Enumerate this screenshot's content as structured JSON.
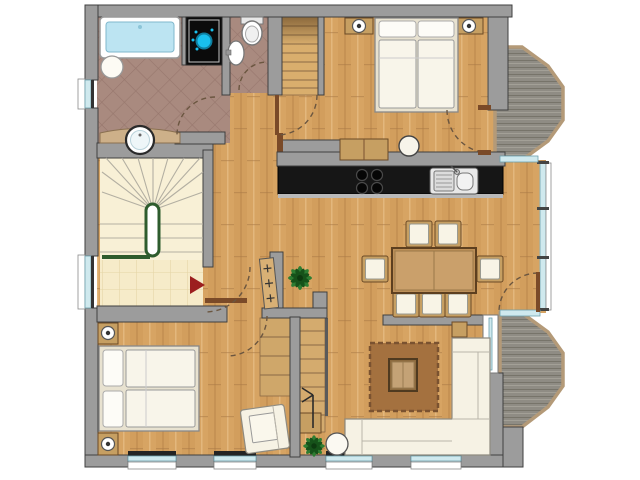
{
  "title": "apartment-floor-plan",
  "colors": {
    "background": "#ffffff",
    "wall": "#9c9c9c",
    "wallStroke": "#3f3f3f",
    "wood": "#d7a463",
    "woodStripe": "#c9934f",
    "bathTile": "#a98a7f",
    "bathTileLine": "#97776d",
    "creamTile": "#f6ebc9",
    "creamTileLine": "#e4d5a5",
    "stairTread": "#f8f0d6",
    "deck": "#8f8c84",
    "deckBorder": "#b49a78",
    "counter": "#161616",
    "counterEdge": "#b9b9b9",
    "fabric": "#f6f2e4",
    "furnitureWood": "#c69f62",
    "rug": "#a4713f",
    "glass": "#cfe9ee",
    "plantGreen": "#2e7d32",
    "plantGreenDark": "#16521a",
    "stairRail": "#2e5c2e",
    "entryArrow": "#9c1f1f",
    "showerBlue": "#19c0ee",
    "tubBlue": "#bce4f2",
    "doorArc": "#6b5640",
    "jamb": "#7a4a28"
  },
  "rooms": [
    {
      "id": "bathroom"
    },
    {
      "id": "wc"
    },
    {
      "id": "bedroom-top"
    },
    {
      "id": "kitchen"
    },
    {
      "id": "dining-area"
    },
    {
      "id": "living-area"
    },
    {
      "id": "bedroom-bottom"
    },
    {
      "id": "entry-hall"
    },
    {
      "id": "staircase-main"
    },
    {
      "id": "staircase-secondary"
    },
    {
      "id": "balcony-top"
    },
    {
      "id": "balcony-bottom"
    }
  ],
  "fixtures": {
    "bathroom": [
      "bathtub",
      "shower",
      "round-basin",
      "vanity-counter",
      "vanity-sink"
    ],
    "wc": [
      "toilet",
      "hand-basin"
    ],
    "bedroom-top": [
      "double-bed",
      "nightstand-left",
      "nightstand-right",
      "table-lamp-left",
      "table-lamp-right",
      "dresser",
      "stool"
    ],
    "bedroom-bottom": [
      "double-bed",
      "nightstand-top",
      "nightstand-bottom",
      "table-lamp-top",
      "table-lamp-bottom",
      "armchair"
    ],
    "kitchen": [
      "counter",
      "cooktop",
      "double-sink",
      "tall-cabinet"
    ],
    "dining-area": [
      "dining-table",
      "dining-chairs",
      "radiator",
      "potted-plant"
    ],
    "living-area": [
      "corner-sofa",
      "side-table",
      "rug",
      "coffee-table",
      "round-table",
      "potted-plant"
    ],
    "entry-hall": [
      "entry-direction-arrow"
    ]
  },
  "counts": {
    "dining_chairs": 7,
    "bottom_windows": 4,
    "balconies": 2,
    "cooktop_burners": 4
  }
}
